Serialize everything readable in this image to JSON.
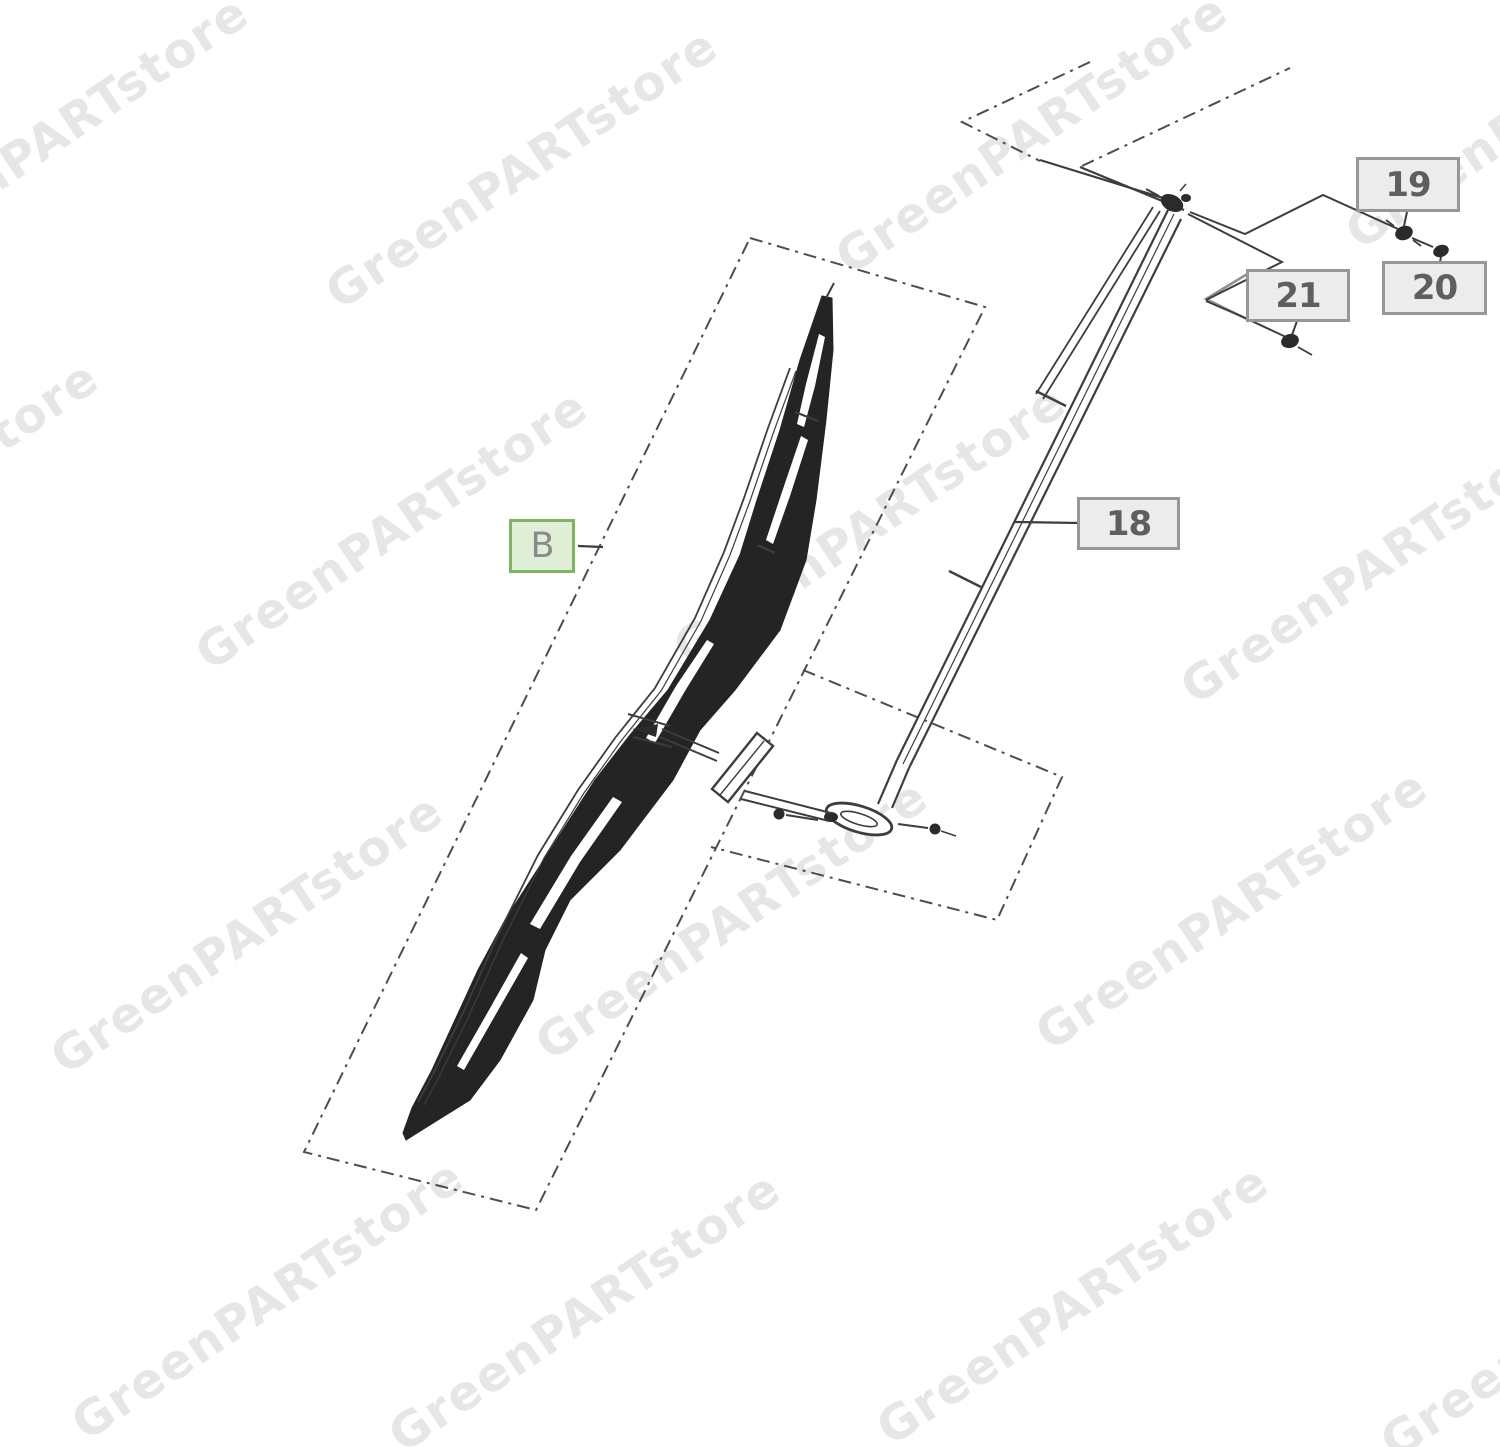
{
  "watermark": {
    "text": "GreenPARTstore",
    "color": "#e6e6e6"
  },
  "callouts": {
    "b": {
      "label": "B"
    },
    "c18": {
      "label": "18"
    },
    "c19": {
      "label": "19"
    },
    "c20": {
      "label": "20"
    },
    "c21": {
      "label": "21"
    }
  },
  "colors": {
    "green_callout_border": "#7fb55f",
    "green_callout_fill": "#dfeed6",
    "gray_callout_border": "#979797",
    "gray_callout_fill": "#ececec",
    "callout_text": "#5f5f5f",
    "line_art": "#3d3d3d",
    "watermark_gray": "#e6e6e6"
  }
}
